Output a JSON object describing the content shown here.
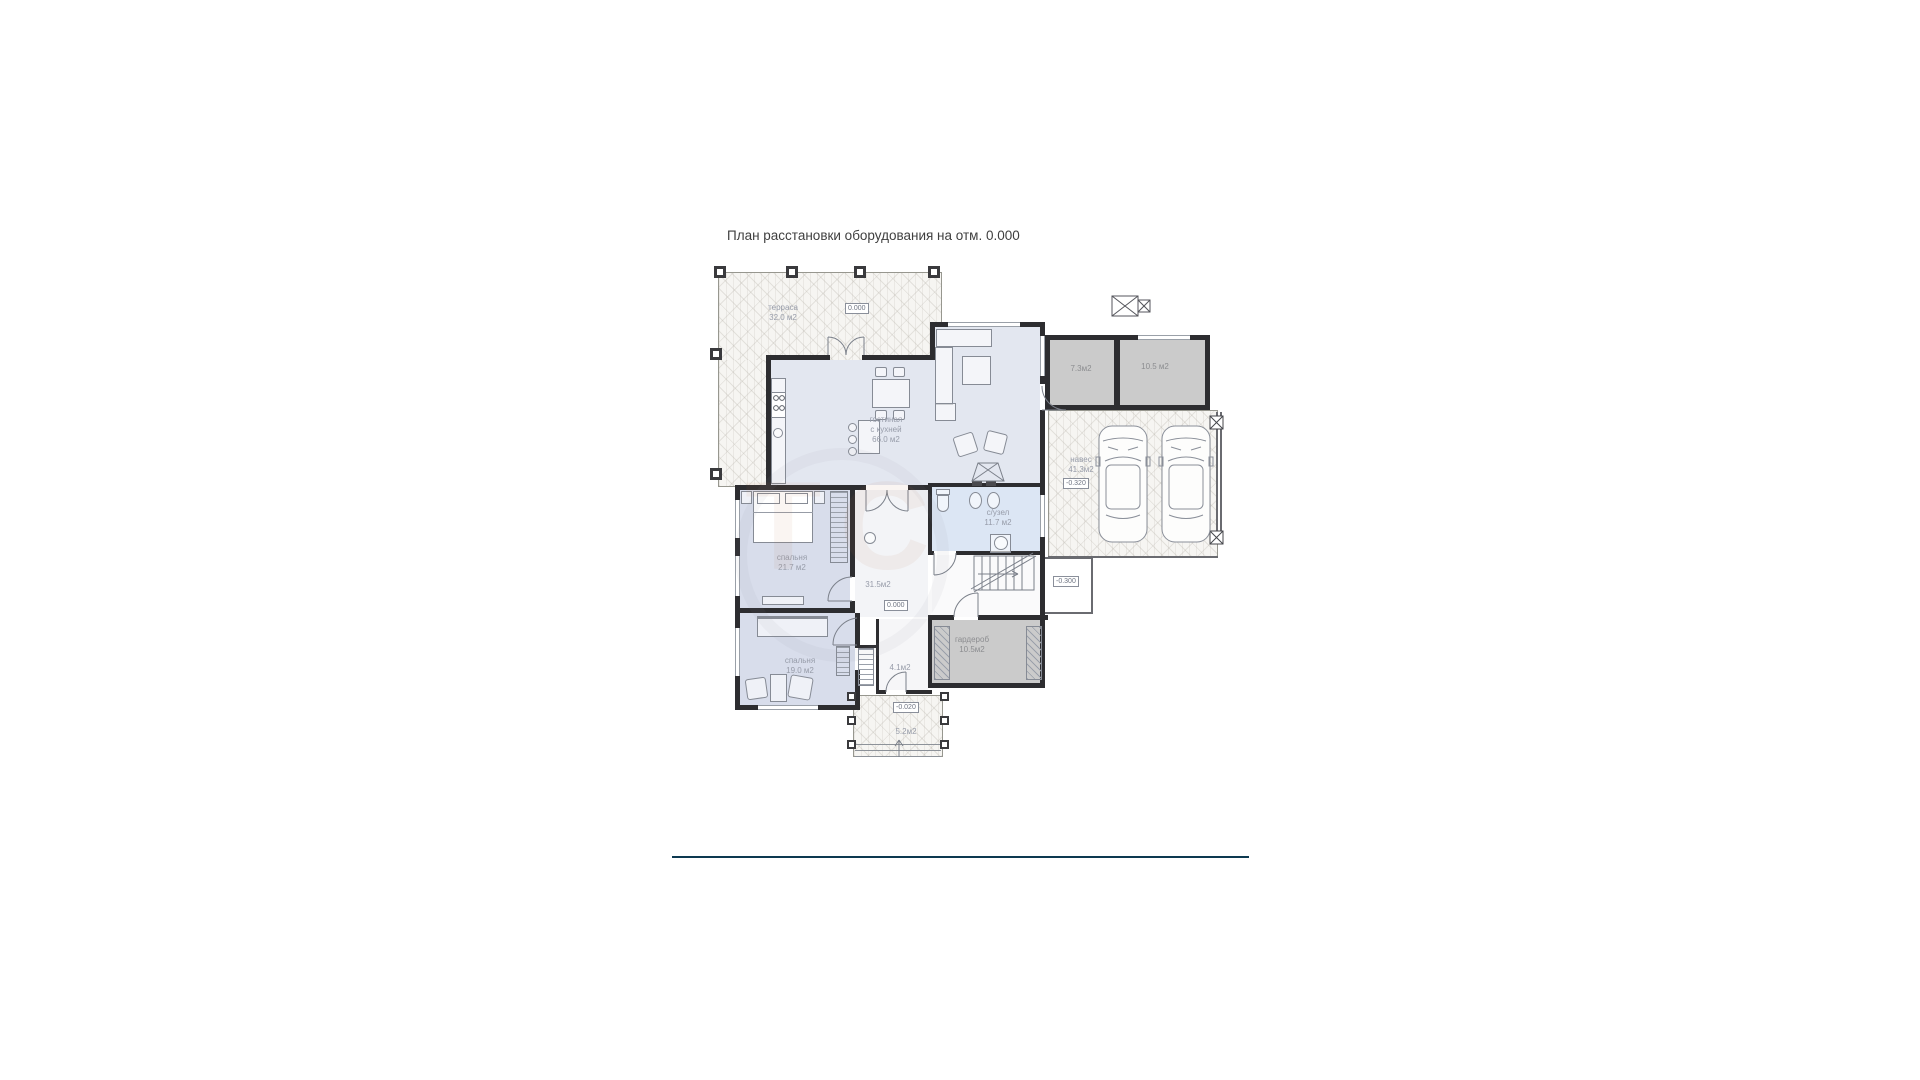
{
  "title": "План  расстановки оборудования на отм. 0.000",
  "rooms": {
    "terrace": {
      "name": "терраса",
      "area": "32.0 м2"
    },
    "living": {
      "line1": "гостиная",
      "line2": "с кухней",
      "area": "66.0 м2"
    },
    "bedroom1": {
      "name": "спальня",
      "area": "21.7 м2"
    },
    "bedroom2": {
      "name": "спальня",
      "area": "19.0 м2"
    },
    "bathroom": {
      "name": "с/узел",
      "area": "11.7 м2"
    },
    "hall": {
      "area": "31.5м2"
    },
    "wardrobe": {
      "name": "гардероб",
      "area": "10.5м2"
    },
    "corridor": {
      "area": "4.1м2"
    },
    "porch": {
      "area": "5.2м2"
    },
    "carport": {
      "name": "навес",
      "area": "41.3м2"
    },
    "storage_small": {
      "area": "7.3м2"
    },
    "storage_large": {
      "area": "10.5 м2"
    }
  },
  "elevations": {
    "terrace": "0.000",
    "hall": "0.000",
    "porch": "-0.020",
    "side": "-0.300",
    "carport": "-0.320"
  },
  "colors": {
    "wall": "#2d2d30",
    "living_fill": "#e3e7f0",
    "bedroom_fill": "#d8ddeb",
    "bathroom_fill": "#dce6f4",
    "storage_fill": "#cbcbcb",
    "footer_line": "#0d3950"
  }
}
